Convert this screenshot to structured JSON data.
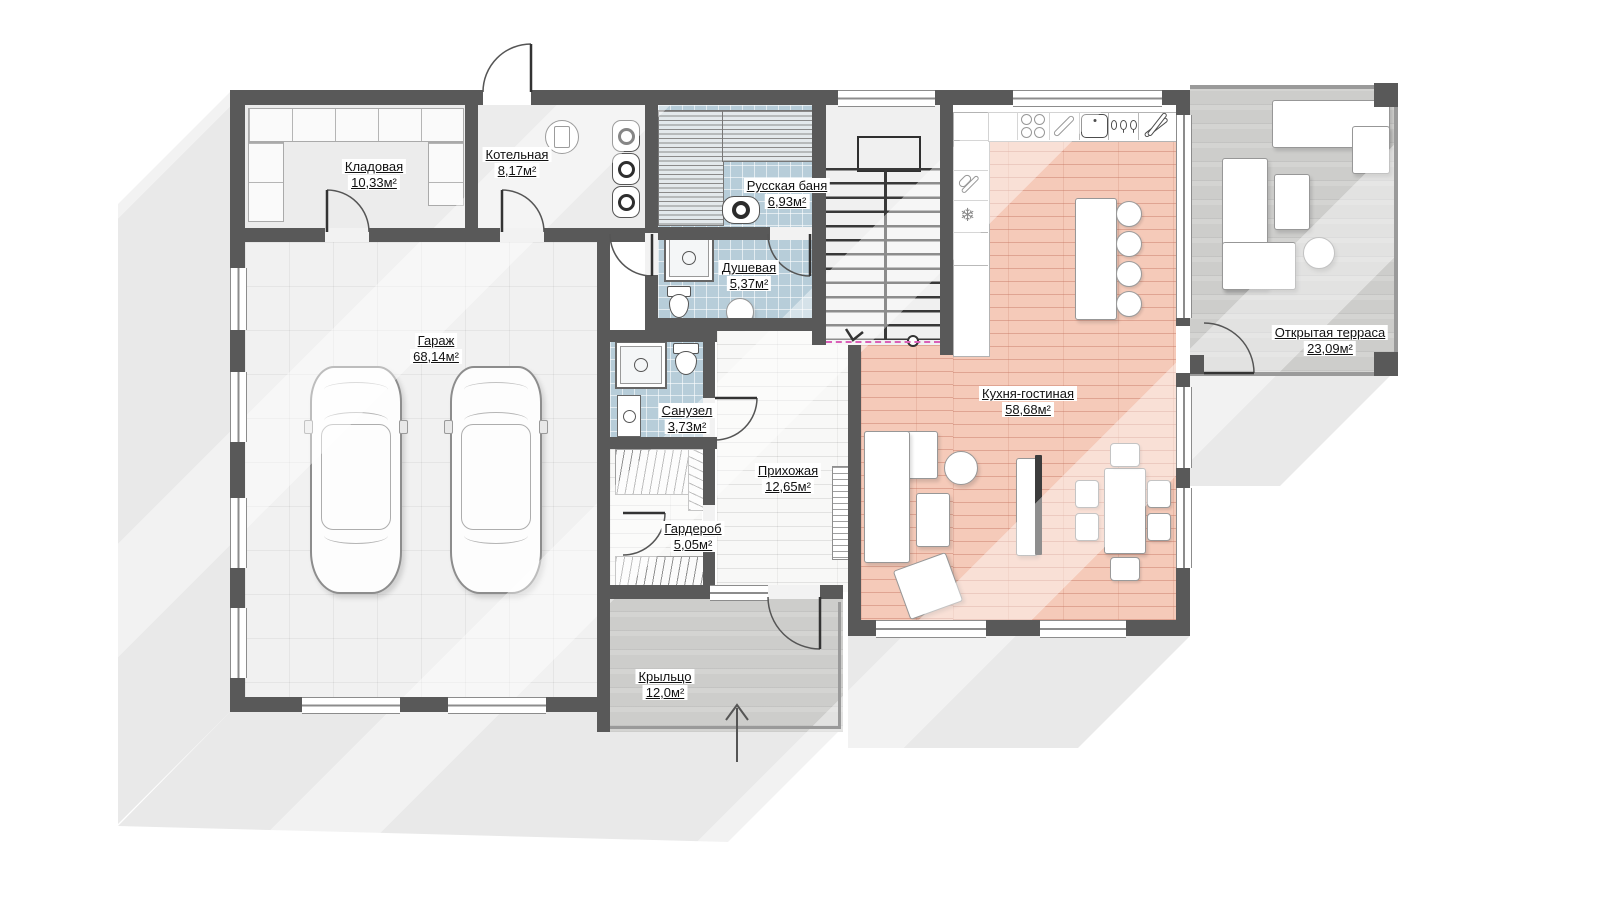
{
  "plan": {
    "title": "Поэтажный план — 1 этаж",
    "rooms": [
      {
        "name": "Кладовая",
        "area": "10,33м²"
      },
      {
        "name": "Котельная",
        "area": "8,17м²"
      },
      {
        "name": "Русская баня",
        "area": "6,93м²"
      },
      {
        "name": "Душевая",
        "area": "5,37м²"
      },
      {
        "name": "Гараж",
        "area": "68,14м²"
      },
      {
        "name": "Санузел",
        "area": "3,73м²"
      },
      {
        "name": "Прихожая",
        "area": "12,65м²"
      },
      {
        "name": "Гардероб",
        "area": "5,05м²"
      },
      {
        "name": "Кухня-гостиная",
        "area": "58,68м²"
      },
      {
        "name": "Открытая терраса",
        "area": "23,09м²"
      },
      {
        "name": "Крыльцо",
        "area": "12,0м²"
      }
    ],
    "colors": {
      "wall": "#595959",
      "kitchen_floor": "#f5cab9",
      "wet_room_floor": "#b7cdd9",
      "wood_deck": "#cdcdcb",
      "shadow": "#e9e9e9",
      "stair_cut_line": "#da5fb7"
    },
    "icons": {
      "snowflake_glyph": "❄",
      "names": [
        "stove-icon",
        "utensil-icon",
        "sink-icon",
        "glassware-icon",
        "tongs-icon",
        "whisk-icon",
        "snowflake-icon",
        "boiler-icon",
        "water-tank-icon",
        "sauna-stove-icon",
        "shower-icon",
        "toilet-icon",
        "washbasin-icon",
        "entrance-arrow-icon",
        "stairs-arrow-icon"
      ]
    }
  }
}
